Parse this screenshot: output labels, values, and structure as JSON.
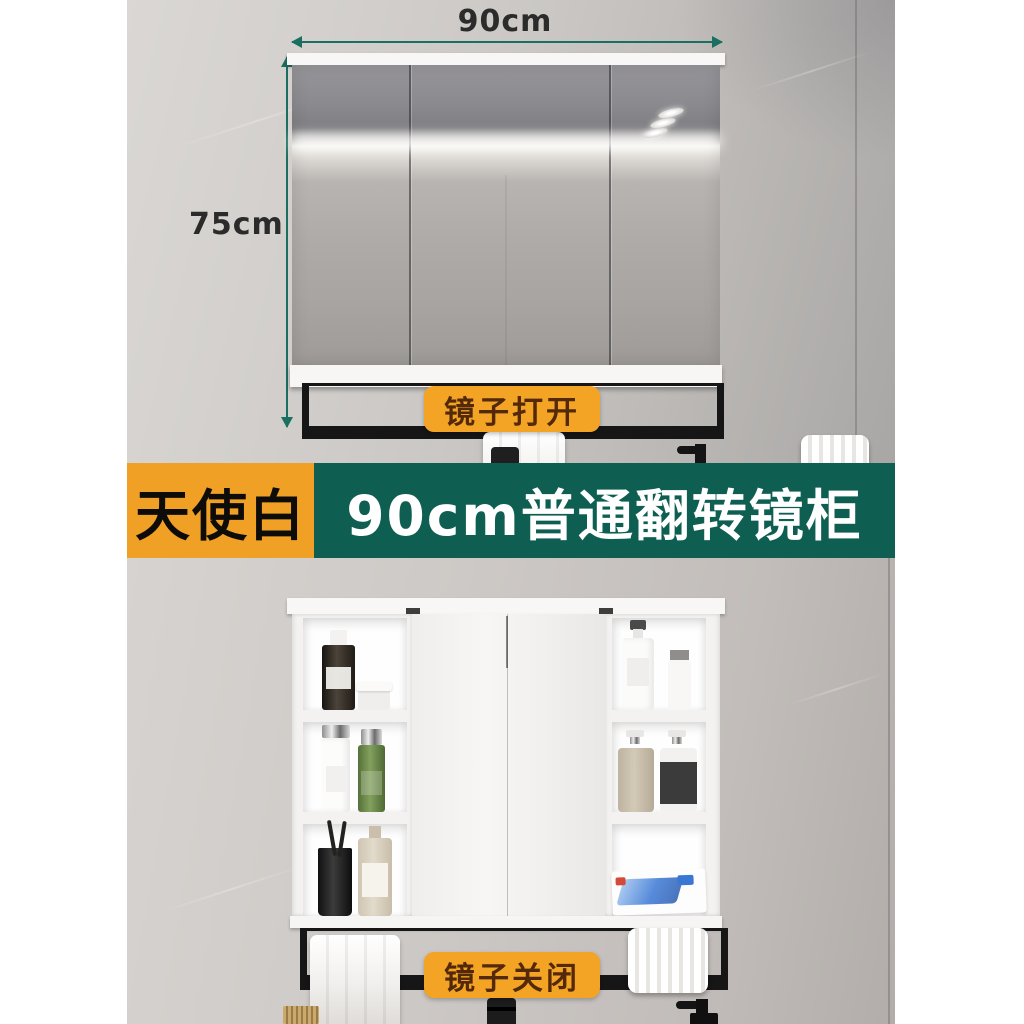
{
  "annotations": {
    "width_label": "90cm",
    "height_label": "75cm",
    "badge_open": "镜子打开",
    "badge_closed": "镜子关闭",
    "arrow_color": "#1a6f60",
    "badge_color": "#f4a424"
  },
  "banner": {
    "color_name": "天使白",
    "title": "90cm普通翻转镜柜",
    "orange": "#f0a125",
    "teal": "#0e5f52"
  },
  "scene": {
    "top_view": "mirror cabinet closed with three mirror doors, towel on black rail",
    "bottom_view": "cabinet open with side shelves of toiletries, towel on black rail"
  }
}
